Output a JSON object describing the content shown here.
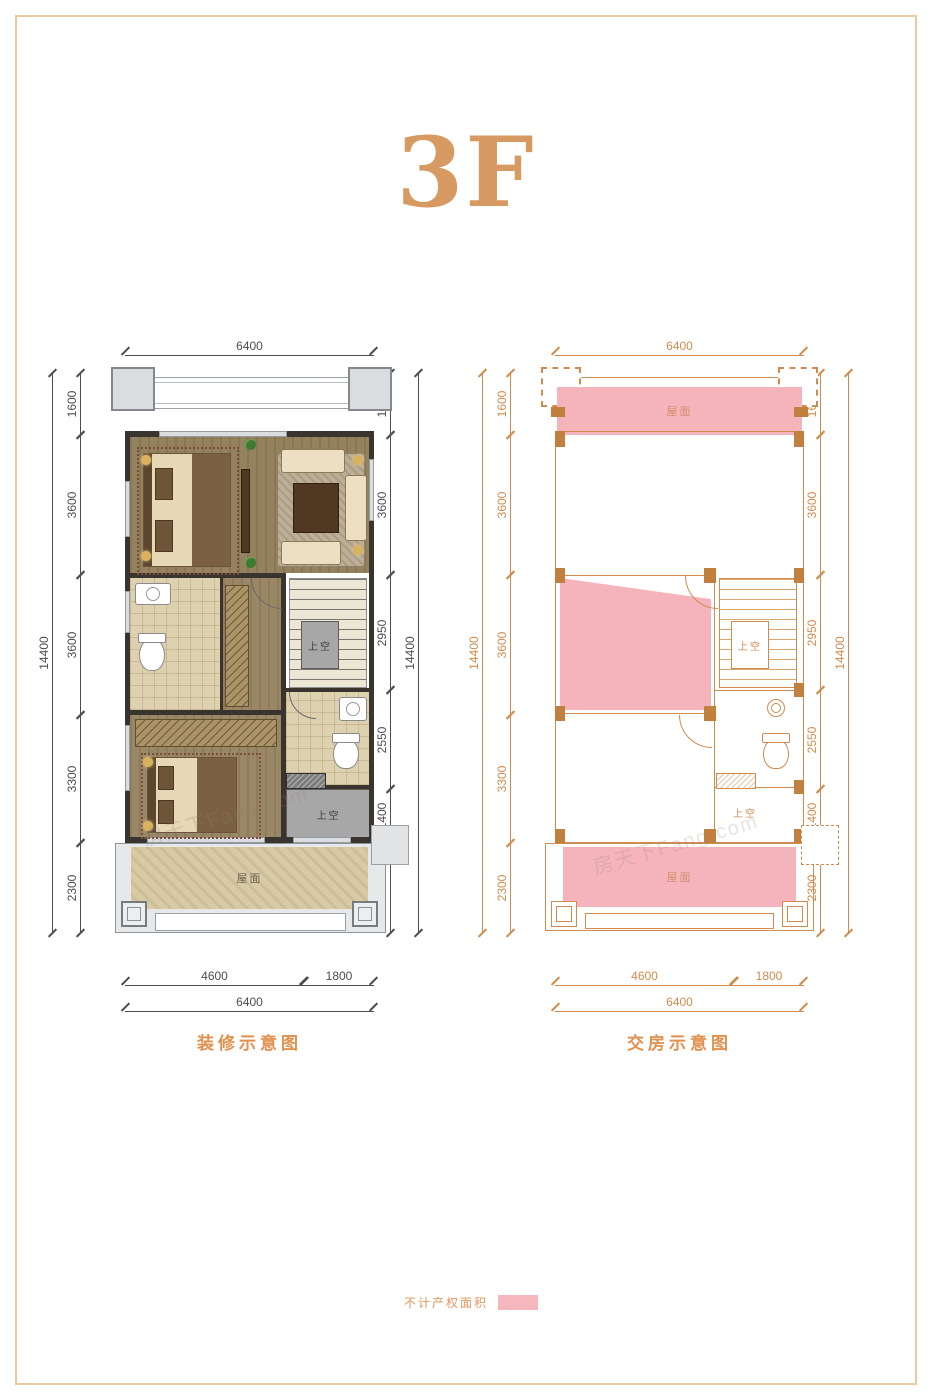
{
  "page": {
    "title": "3F"
  },
  "watermark": "房天下Fang.com",
  "legend": {
    "label": "不计产权面积",
    "swatch_color": "#f5b6be"
  },
  "colors": {
    "accent_orange": "#d79a62",
    "caption_orange": "#e2904d",
    "plan_line_orange": "#cf8c4e",
    "pink_area": "#f5b4bb",
    "dim_gray": "#4d4d4d",
    "wall_dark": "#3a342e",
    "wood_floor": "#94825f",
    "tile_floor": "#ded1b0",
    "void_gray": "#a7a7a7"
  },
  "plans": [
    {
      "caption": "装修示意图",
      "dims": {
        "top_total": "6400",
        "left_total": "14400",
        "left_segments": [
          "1600",
          "3600",
          "3600",
          "3300",
          "2300"
        ],
        "right_total": "14400",
        "right_segments": [
          "1600",
          "3600",
          "2950",
          "2550",
          "1400",
          "2300"
        ],
        "bottom_segments": [
          "4600",
          "1800"
        ],
        "bottom_total": "6400"
      },
      "labels": {
        "terrace": "屋面",
        "stair_void": "上空",
        "void": "上空"
      }
    },
    {
      "caption": "交房示意图",
      "dims": {
        "top_total": "6400",
        "left_total": "14400",
        "left_segments": [
          "1600",
          "3600",
          "3600",
          "3300",
          "2300"
        ],
        "right_total": "14400",
        "right_segments": [
          "1600",
          "3600",
          "2950",
          "2550",
          "1400",
          "2300"
        ],
        "bottom_segments": [
          "4600",
          "1800"
        ],
        "bottom_total": "6400"
      },
      "labels": {
        "roof": "屋面",
        "terrace": "屋面",
        "stair_void": "上空",
        "void": "上空"
      }
    }
  ]
}
